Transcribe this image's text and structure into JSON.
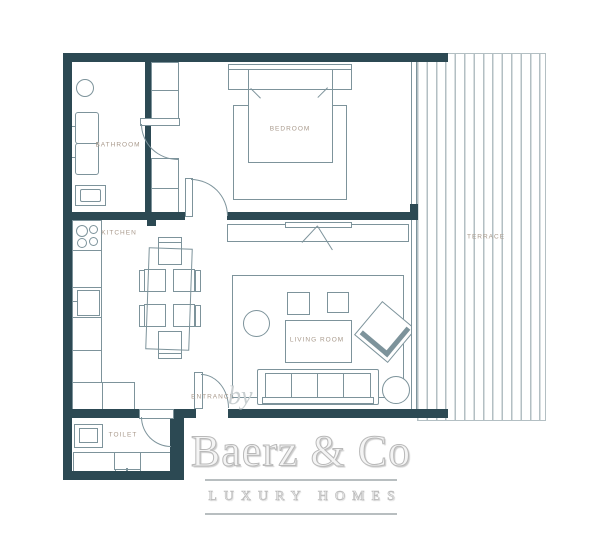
{
  "rooms": {
    "bathroom": "BATHROOM",
    "bedroom": "BEDROOM",
    "kitchen": "KITCHEN",
    "living_room": "LIVING ROOM",
    "toilet": "TOILET",
    "entrance": "ENTRANCE",
    "terrace": "TERRACE"
  },
  "brand": {
    "prefix": "by",
    "name": "Baerz & Co",
    "tagline": "LUXURY HOMES"
  },
  "colors": {
    "wall": "#2c4953",
    "line": "#7d939b",
    "label": "#a99a8c",
    "stripe": "#b3bfc3",
    "wm": "#c9cfd1"
  }
}
